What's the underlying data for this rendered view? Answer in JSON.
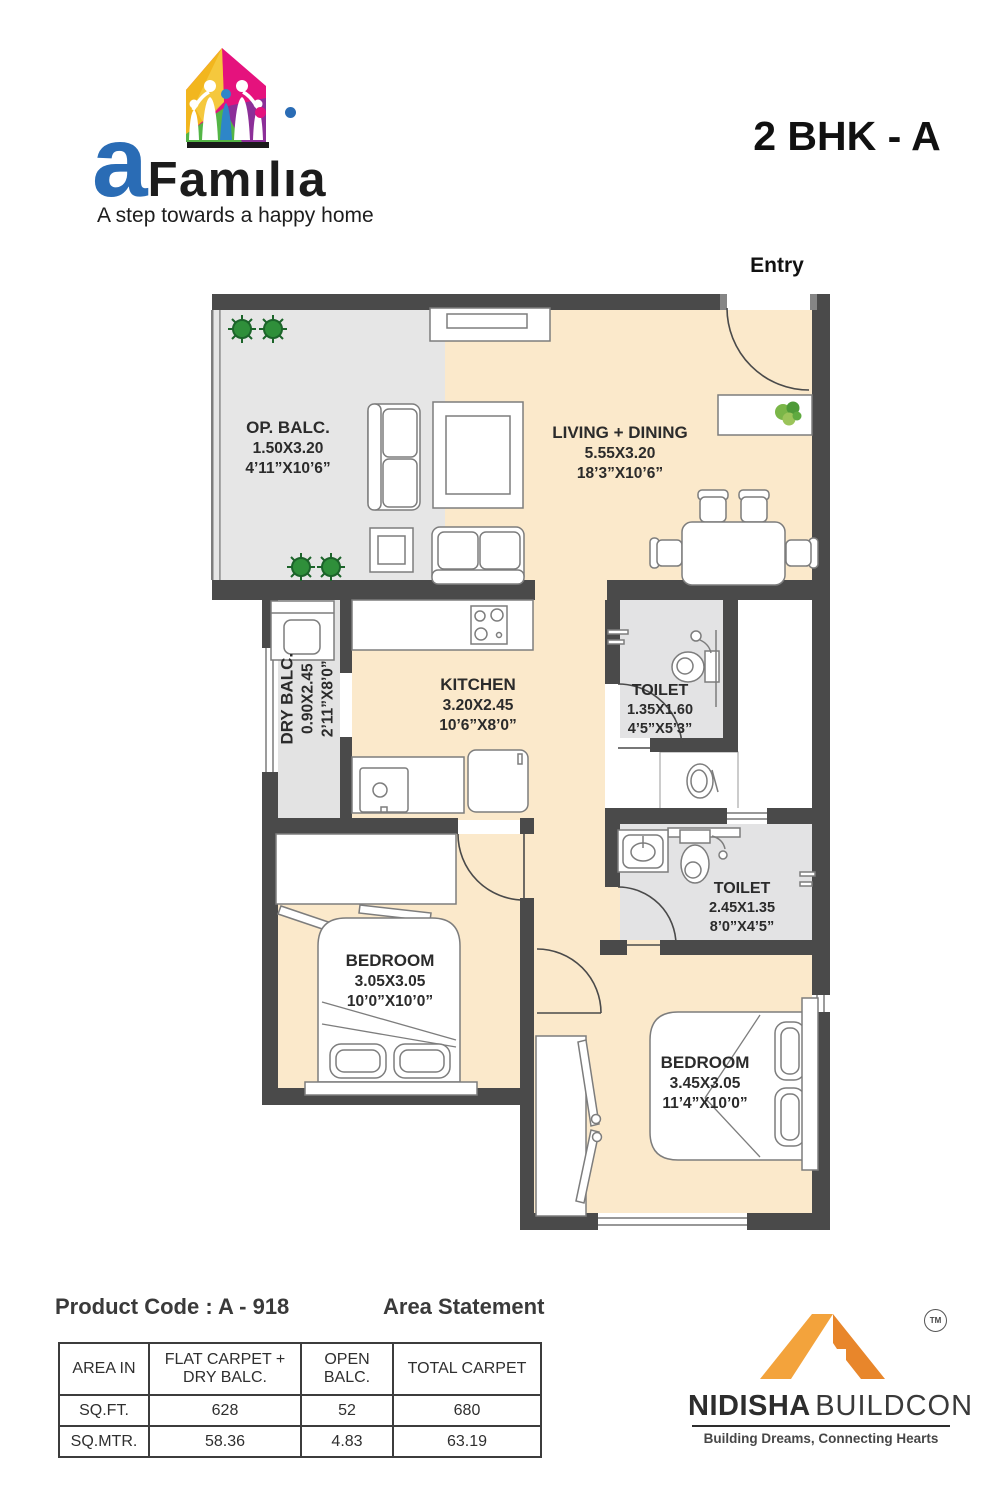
{
  "header": {
    "brand": {
      "wordmark": "aFamilia",
      "part_a": "a",
      "part_fam": "Fam",
      "part_i1": "ı",
      "part_l": "l",
      "part_i2": "ı",
      "part_a2": "a",
      "tagline": "A step towards a happy home"
    },
    "unit_title": "2 BHK - A"
  },
  "plan": {
    "entry_label": "Entry",
    "rooms": {
      "op_balc": {
        "name": "OP. BALC.",
        "dim_m": "1.50X3.20",
        "dim_ft": "4’11”X10’6”"
      },
      "living": {
        "name": "LIVING + DINING",
        "dim_m": "5.55X3.20",
        "dim_ft": "18’3”X10’6”"
      },
      "dry_balc": {
        "name": "DRY BALC.",
        "dim_m": "0.90X2.45",
        "dim_ft": "2’11”X8’0”"
      },
      "kitchen": {
        "name": "KITCHEN",
        "dim_m": "3.20X2.45",
        "dim_ft": "10’6”X8’0”"
      },
      "toilet1": {
        "name": "TOILET",
        "dim_m": "1.35X1.60",
        "dim_ft": "4’5”X5’3”"
      },
      "toilet2": {
        "name": "TOILET",
        "dim_m": "2.45X1.35",
        "dim_ft": "8’0”X4’5”"
      },
      "bedroom1": {
        "name": "BEDROOM",
        "dim_m": "3.05X3.05",
        "dim_ft": "10’0”X10’0”"
      },
      "bedroom2": {
        "name": "BEDROOM",
        "dim_m": "3.45X3.05",
        "dim_ft": "11’4”X10’0”"
      }
    }
  },
  "footer": {
    "product_code": "Product Code : A - 918",
    "area_statement_title": "Area Statement",
    "table": {
      "headers": [
        "AREA IN",
        "FLAT CARPET + DRY BALC.",
        "OPEN BALC.",
        "TOTAL CARPET"
      ],
      "rows": [
        [
          "SQ.FT.",
          "628",
          "52",
          "680"
        ],
        [
          "SQ.MTR.",
          "58.36",
          "4.83",
          "63.19"
        ]
      ]
    },
    "builder": {
      "name_bold": "NIDISHA",
      "name_light": "BUILDCON",
      "tagline": "Building Dreams, Connecting Hearts",
      "tm": "TM"
    }
  },
  "colors": {
    "wall": "#4a4a4a",
    "floor_cream": "#fbe9cb",
    "floor_gray": "#e5e5e5",
    "accent_pink": "#e5127d",
    "accent_blue": "#2a6cb5",
    "accent_orange_light": "#f3a33c",
    "accent_orange_dark": "#e8862b"
  }
}
